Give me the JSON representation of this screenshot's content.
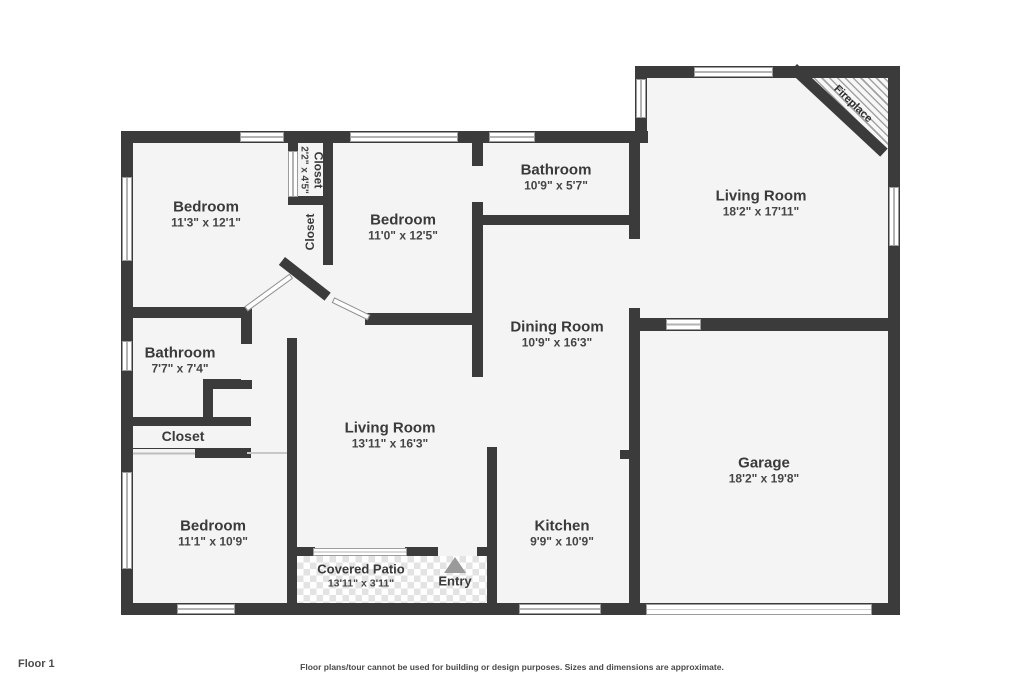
{
  "footer": {
    "floor_label": "Floor 1",
    "disclaimer": "Floor plans/tour cannot be used for building or design purposes. Sizes and dimensions are approximate."
  },
  "rooms": {
    "bedroom_top_left": {
      "name": "Bedroom",
      "dims": "11'3\" x 12'1\""
    },
    "closet_top": {
      "name": "Closet",
      "dims": "2'2\" x 4'5\""
    },
    "closet_mid": {
      "name": "Closet"
    },
    "bedroom_top_mid": {
      "name": "Bedroom",
      "dims": "11'0\" x 12'5\""
    },
    "bathroom_top": {
      "name": "Bathroom",
      "dims": "10'9\" x 5'7\""
    },
    "living_room_right": {
      "name": "Living Room",
      "dims": "18'2\" x 17'11\""
    },
    "fireplace": {
      "name": "Fireplace"
    },
    "bathroom_left": {
      "name": "Bathroom",
      "dims": "7'7\" x 7'4\""
    },
    "closet_left": {
      "name": "Closet"
    },
    "dining_room": {
      "name": "Dining Room",
      "dims": "10'9\" x 16'3\""
    },
    "living_room_center": {
      "name": "Living Room",
      "dims": "13'11\" x 16'3\""
    },
    "bedroom_bottom_left": {
      "name": "Bedroom",
      "dims": "11'1\" x 10'9\""
    },
    "kitchen": {
      "name": "Kitchen",
      "dims": "9'9\" x 10'9\""
    },
    "garage": {
      "name": "Garage",
      "dims": "18'2\" x 19'8\""
    },
    "covered_patio": {
      "name": "Covered Patio",
      "dims": "13'11\" x 3'11\""
    },
    "entry": {
      "name": "Entry"
    }
  },
  "colors": {
    "wall": "#3b3b3b",
    "room_fill": "#f4f4f4",
    "patio_tile": "#e3e3e3",
    "entry_arrow": "#9a9a9a",
    "text": "#3a3a3a"
  }
}
